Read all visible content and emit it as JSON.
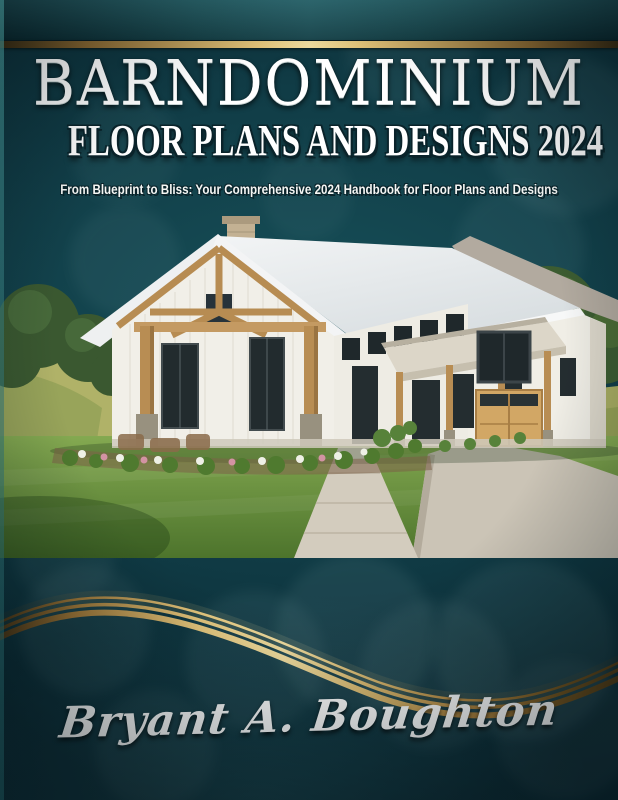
{
  "cover": {
    "title": "BARNDOMINIUM",
    "series_line": "FLOOR PLANS AND DESIGNS 2024",
    "tagline": "From Blueprint to Bliss: Your Comprehensive 2024 Handbook for Floor Plans and Designs",
    "author": "Bryant A. Boughton",
    "illustration_alt": "White barndominium farmhouse with timber-frame gable, stone post bases, metal porch awning, wooden garage door, green lawn, concrete walkway and driveway, trees on both sides"
  },
  "colors": {
    "background_teal": "#0d3540",
    "band_teal": "#1d545c",
    "gold": "#e7c87c",
    "gold_dark": "#8a6730",
    "text_white": "#ffffff"
  }
}
